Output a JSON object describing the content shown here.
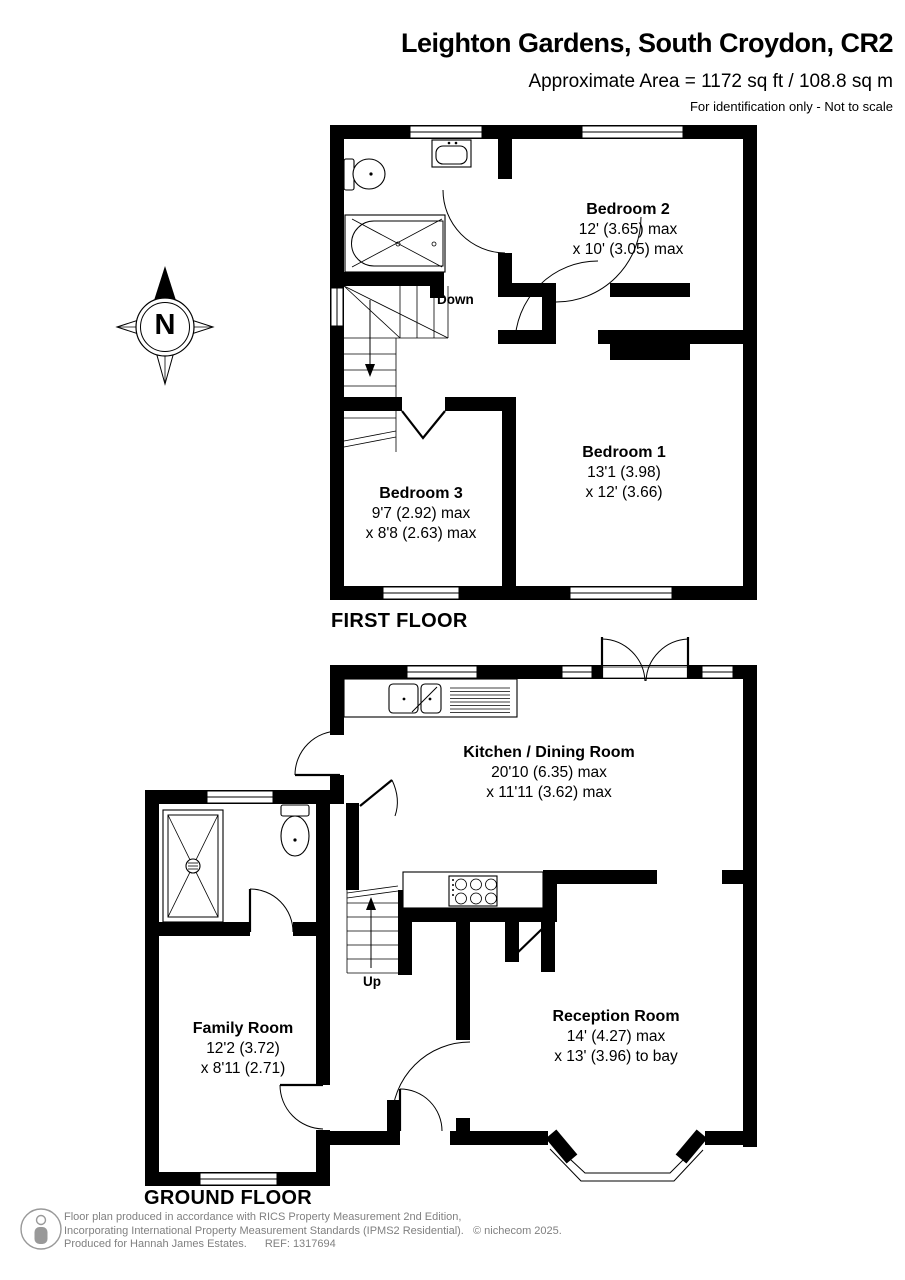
{
  "header": {
    "title": "Leighton Gardens, South Croydon, CR2",
    "area_line": "Approximate Area = 1172 sq ft / 108.8 sq m",
    "disclaimer": "For identification only - Not to scale"
  },
  "compass": {
    "north_label": "N"
  },
  "first_floor": {
    "caption": "FIRST FLOOR",
    "stairs_label": "Down",
    "rooms": [
      {
        "name": "Bedroom 2",
        "dim1": "12' (3.65) max",
        "dim2": "x 10' (3.05) max"
      },
      {
        "name": "Bedroom 1",
        "dim1": "13'1 (3.98)",
        "dim2": "x 12' (3.66)"
      },
      {
        "name": "Bedroom 3",
        "dim1": "9'7 (2.92) max",
        "dim2": "x 8'8 (2.63) max"
      }
    ]
  },
  "ground_floor": {
    "caption": "GROUND FLOOR",
    "stairs_label": "Up",
    "rooms": [
      {
        "name": "Kitchen / Dining Room",
        "dim1": "20'10 (6.35) max",
        "dim2": "x 11'11 (3.62) max"
      },
      {
        "name": "Reception Room",
        "dim1": "14' (4.27) max",
        "dim2": "x 13' (3.96) to bay"
      },
      {
        "name": "Family Room",
        "dim1": "12'2 (3.72)",
        "dim2": "x 8'11 (2.71)"
      }
    ]
  },
  "footer": {
    "line1": "Floor plan produced in accordance with RICS Property Measurement 2nd Edition,",
    "line2": "Incorporating International Property Measurement Standards (IPMS2 Residential).",
    "line3": "Produced for Hannah James Estates.",
    "ref": "REF: 1317694",
    "copyright": "© nichecom 2025."
  },
  "colors": {
    "wall": "#000000",
    "text": "#000000",
    "footer_text": "#808080",
    "background": "#ffffff"
  }
}
